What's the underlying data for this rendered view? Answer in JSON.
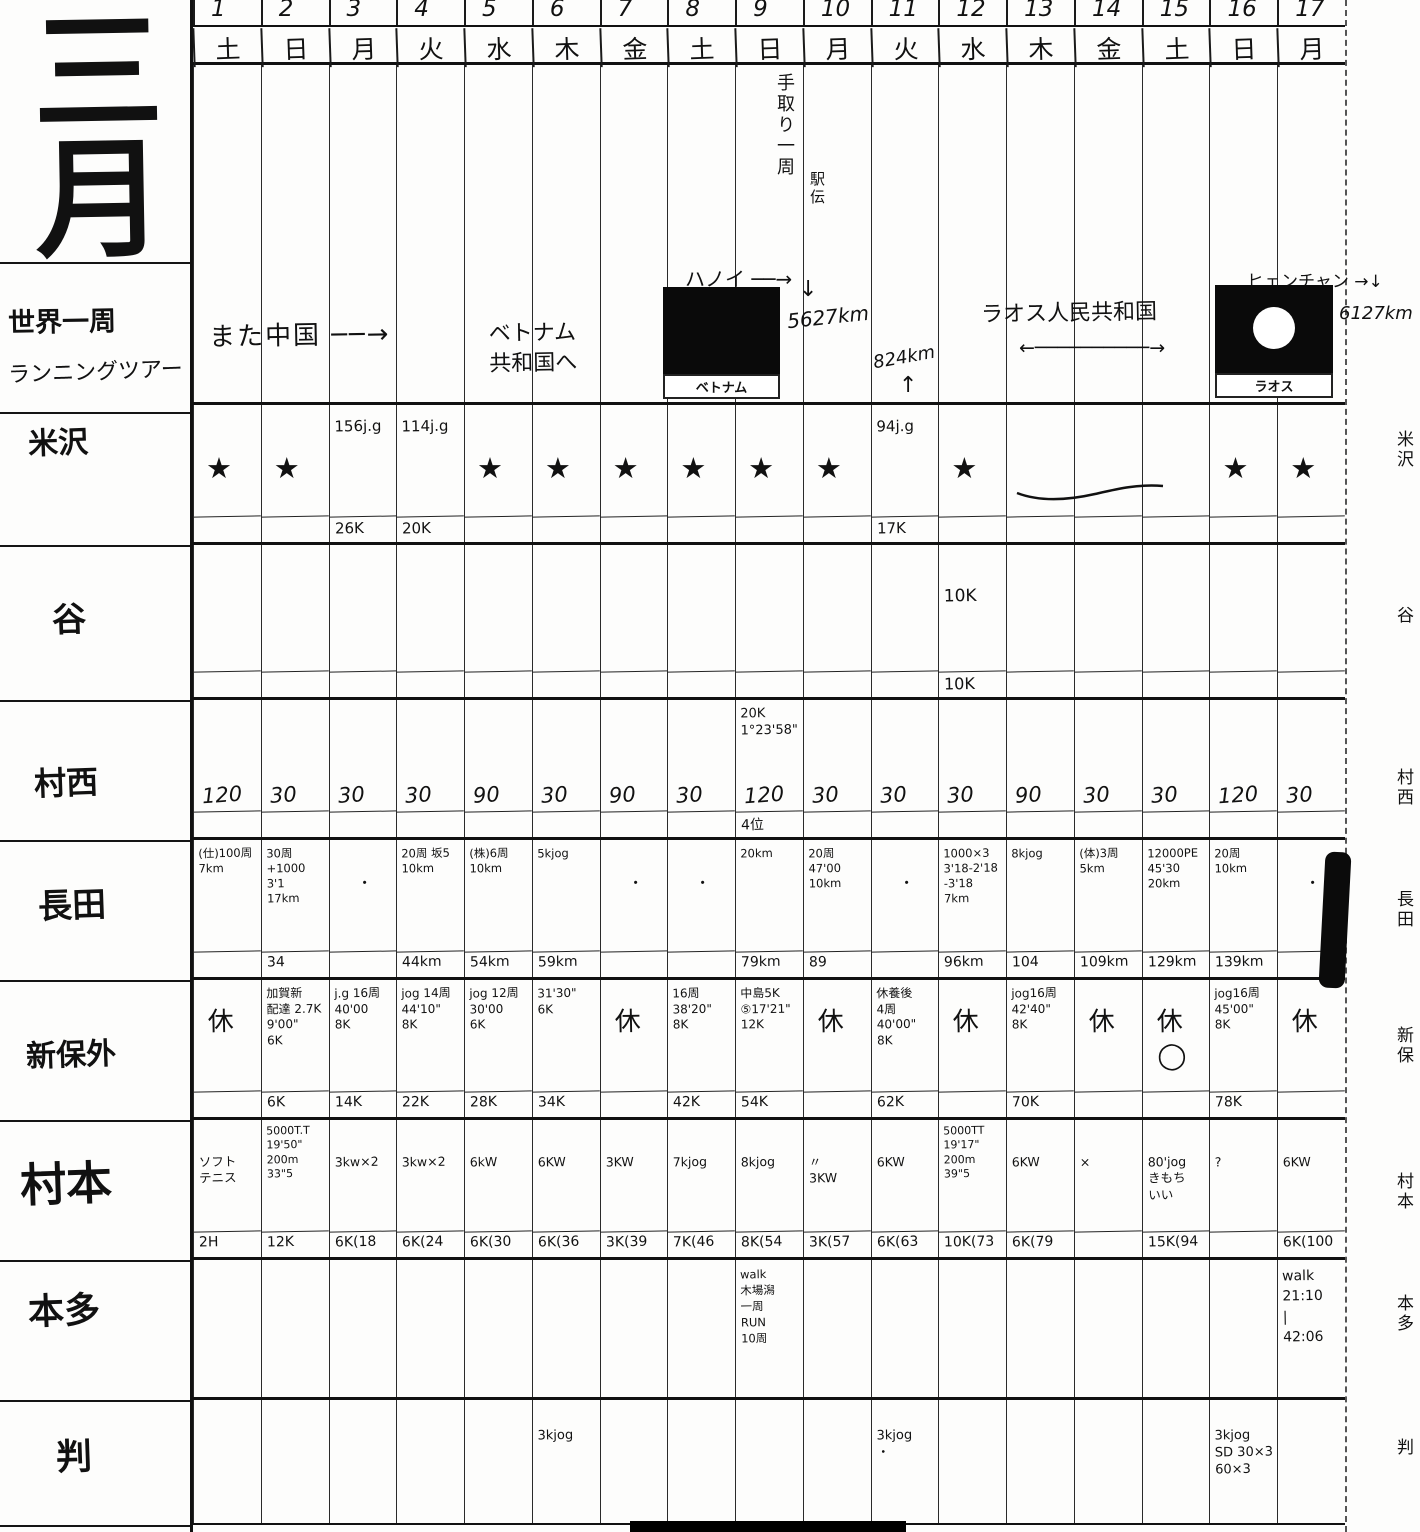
{
  "left_panel": {
    "month": "三\n月",
    "subtitle1": "世界一周",
    "subtitle2": "ランニングツアー",
    "labels": [
      "米沢",
      "谷",
      "村西",
      "長田",
      "新保外",
      "村本",
      "本多",
      "判"
    ]
  },
  "header": {
    "day_numbers": [
      "1",
      "2",
      "3",
      "4",
      "5",
      "6",
      "7",
      "8",
      "9",
      "10",
      "11",
      "12",
      "13",
      "14",
      "15",
      "16",
      "17"
    ],
    "weekdays": [
      "土",
      "日",
      "月",
      "火",
      "水",
      "木",
      "金",
      "土",
      "日",
      "月",
      "火",
      "水",
      "木",
      "金",
      "土",
      "日",
      "月"
    ]
  },
  "banner": {
    "tedori_note": "手取り一周",
    "tedori_note2": "駅伝",
    "china_note": "また中国 ──→",
    "vietnam_note": "ベトナム\n共和国へ",
    "hanoi_label": "ハノイ ──→",
    "hanoi_arrow": "↓",
    "hanoi_km": "5627km",
    "vietnam_flag_caption": "ベトナム",
    "mid_km": "824km",
    "mid_arrow": "↑",
    "laos_note": "ラオス人民共和国",
    "laos_arrow": "←──────────→",
    "vientiane_label": "ヒェンチャン →↓",
    "vientiane_km": "6127km",
    "laos_flag_caption": "ラオス"
  },
  "right_labels": [
    "米沢",
    "谷",
    "村西",
    "長田",
    "新保",
    "村本",
    "本多",
    "判"
  ],
  "rows": [
    {
      "id": "yonezawa",
      "label": "米沢",
      "cells": [
        {
          "star": "★"
        },
        {
          "star": "★"
        },
        {
          "top": "156j.g",
          "bot": "26K"
        },
        {
          "top": "114j.g",
          "bot": "20K"
        },
        {
          "star": "★"
        },
        {
          "star": "★"
        },
        {
          "star": "★"
        },
        {
          "star": "★"
        },
        {
          "star": "★"
        },
        {
          "star": "★"
        },
        {
          "top": "94j.g",
          "bot": "17K"
        },
        {
          "star": "★"
        },
        {},
        {},
        {},
        {
          "star": "★"
        },
        {
          "star": "★"
        }
      ]
    },
    {
      "id": "tani",
      "label": "谷",
      "cells": [
        {},
        {},
        {},
        {},
        {},
        {},
        {},
        {},
        {},
        {},
        {},
        {
          "top": "10K",
          "bot": "10K",
          "cls": "mid"
        },
        {},
        {},
        {},
        {},
        {}
      ]
    },
    {
      "id": "muranishi",
      "label": "村西",
      "cells": [
        {
          "num": "120"
        },
        {
          "num": "30"
        },
        {
          "num": "30"
        },
        {
          "num": "30"
        },
        {
          "num": "90"
        },
        {
          "num": "30"
        },
        {
          "num": "90"
        },
        {
          "num": "30"
        },
        {
          "top": "20K\n1°23'58\"",
          "num": "120",
          "bot": "4位"
        },
        {
          "num": "30"
        },
        {
          "num": "30"
        },
        {
          "num": "30"
        },
        {
          "num": "90"
        },
        {
          "num": "30"
        },
        {
          "num": "30"
        },
        {
          "num": "120"
        },
        {
          "num": "30"
        }
      ]
    },
    {
      "id": "nagata",
      "label": "長田",
      "cells": [
        {
          "top": "(仕)100周\n7km"
        },
        {
          "top": "30周\n+1000 3'1\n17km",
          "bot": "34"
        },
        {
          "top": "・",
          "cls": "dot"
        },
        {
          "top": "20周 坂5\n10km",
          "bot": "44km"
        },
        {
          "top": "(株)6周\n10km",
          "bot": "54km"
        },
        {
          "top": "5kjog",
          "bot": "59km"
        },
        {
          "top": "・",
          "cls": "dot"
        },
        {
          "top": "・",
          "cls": "dot"
        },
        {
          "top": "20km",
          "bot": "79km"
        },
        {
          "top": "20周\n47'00\n10km",
          "bot": "89"
        },
        {
          "top": "・",
          "cls": "dot"
        },
        {
          "top": "1000×3\n3'18-2'18\n-3'18\n7km",
          "bot": "96km"
        },
        {
          "top": "8kjog",
          "bot": "104"
        },
        {
          "top": "(体)3周\n5km",
          "bot": "109km"
        },
        {
          "top": "12000PE\n45'30\n20km",
          "bot": "129km"
        },
        {
          "top": "20周\n10km",
          "bot": "139km"
        },
        {
          "top": "・",
          "cls": "dot"
        }
      ]
    },
    {
      "id": "shinbo",
      "label": "新保外",
      "cells": [
        {
          "top": "休",
          "cls": "rest"
        },
        {
          "top": "加賀新\n配達 2.7K\n9'00\"\n6K",
          "bot": "6K"
        },
        {
          "top": "j.g 16周\n40'00\n8K",
          "bot": "14K"
        },
        {
          "top": "jog 14周\n44'10\"\n8K",
          "bot": "22K"
        },
        {
          "top": "jog 12周\n30'00\n6K",
          "bot": "28K"
        },
        {
          "top": "31'30\"\n6K",
          "bot": "34K"
        },
        {
          "top": "休",
          "cls": "rest"
        },
        {
          "top": "16周\n38'20\"\n8K",
          "bot": "42K"
        },
        {
          "top": "中島5K\n⑤17'21\"\n12K",
          "bot": "54K"
        },
        {
          "top": "休",
          "cls": "rest"
        },
        {
          "top": "休養後\n4周 40'00\"\n8K",
          "bot": "62K"
        },
        {
          "top": "休",
          "cls": "rest"
        },
        {
          "top": "jog16周\n42'40\"\n8K",
          "bot": "70K"
        },
        {
          "top": "休",
          "cls": "rest"
        },
        {
          "top": "休\n◯",
          "cls": "rest"
        },
        {
          "top": "jog16周\n45'00\"\n8K",
          "bot": "78K"
        },
        {
          "top": "休",
          "cls": "rest"
        }
      ]
    },
    {
      "id": "muramoto",
      "label": "村本",
      "cells": [
        {
          "top": "ソフト\nテニス",
          "bot": "2H"
        },
        {
          "top": "5000T.T\n19'50\"\n200m\n33\"5",
          "bot": "12K",
          "cls": "small"
        },
        {
          "top": "3kw×2",
          "bot": "6K(18"
        },
        {
          "top": "3kw×2",
          "bot": "6K(24"
        },
        {
          "top": "6kW",
          "bot": "6K(30"
        },
        {
          "top": "6KW",
          "bot": "6K(36"
        },
        {
          "top": "3KW",
          "bot": "3K(39"
        },
        {
          "top": "7kjog",
          "bot": "7K(46"
        },
        {
          "top": "8kjog",
          "bot": "8K(54"
        },
        {
          "top": "〃\n3KW",
          "bot": "3K(57"
        },
        {
          "top": "6KW",
          "bot": "6K(63"
        },
        {
          "top": "5000TT\n19'17\"\n200m\n39\"5",
          "bot": "10K(73",
          "cls": "small"
        },
        {
          "top": "6KW",
          "bot": "6K(79"
        },
        {
          "top": "×"
        },
        {
          "top": "80'jog\nきもち\nいい",
          "bot": "15K(94"
        },
        {
          "top": "?"
        },
        {
          "top": "6KW",
          "bot": "6K(100"
        }
      ]
    },
    {
      "id": "honda",
      "label": "本多",
      "cells": [
        {},
        {},
        {},
        {},
        {},
        {},
        {},
        {},
        {
          "top": "walk\n木場潟\n一周\nRUN\n10周",
          "cls": "tiny"
        },
        {},
        {},
        {},
        {},
        {},
        {},
        {},
        {
          "top": "walk\n21:10\n|\n42:06"
        }
      ]
    },
    {
      "id": "han",
      "label": "判",
      "cells": [
        {},
        {},
        {},
        {},
        {},
        {
          "top": "3kjog",
          "cls": "mid"
        },
        {},
        {},
        {},
        {},
        {
          "top": "3kjog\n・",
          "cls": "mid"
        },
        {},
        {},
        {},
        {},
        {
          "top": "3kjog\nSD 30×3\n60×3",
          "cls": "mid"
        },
        {}
      ]
    }
  ]
}
